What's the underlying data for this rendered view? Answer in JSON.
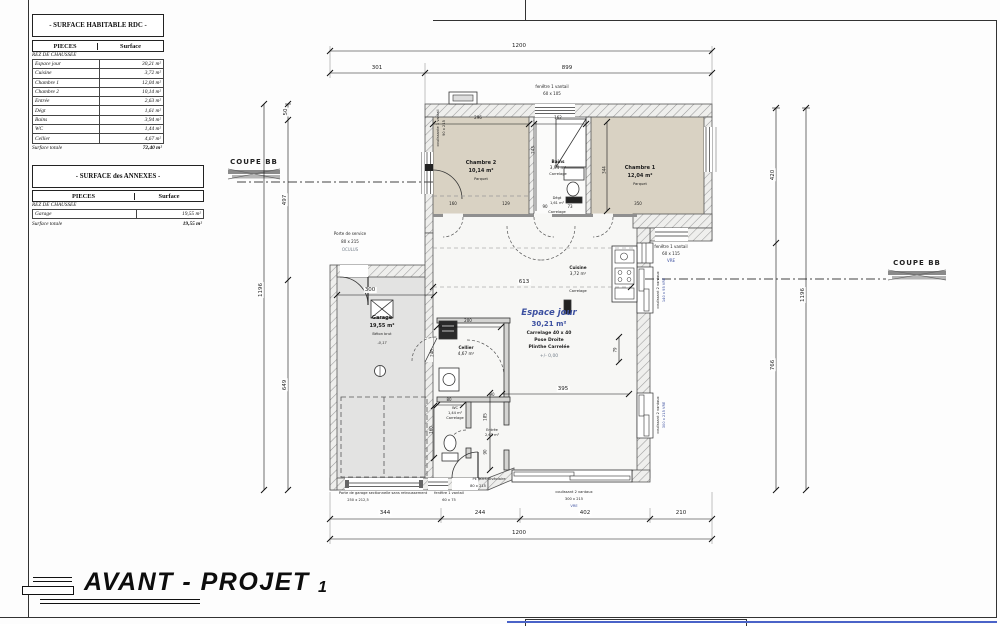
{
  "tables": {
    "habitable": {
      "title": "- SURFACE HABITABLE RDC -",
      "col1": "PIECES",
      "col2": "Surface",
      "section": "REZ DE CHAUSSEE",
      "rows": [
        [
          "Espace jour",
          "30,21 m²"
        ],
        [
          "Cuisine",
          "3,72 m²"
        ],
        [
          "Chambre 1",
          "12,04 m²"
        ],
        [
          "Chambre 2",
          "10,14 m²"
        ],
        [
          "Entrée",
          "2,63 m²"
        ],
        [
          "Dégt",
          "1,61 m²"
        ],
        [
          "Bains",
          "3,94 m²"
        ],
        [
          "WC",
          "1,44 m²"
        ],
        [
          "Cellier",
          "4,67 m²"
        ]
      ],
      "total_label": "Surface totale",
      "total": "72,40 m²"
    },
    "annexes": {
      "title": "- SURFACE des ANNEXES -",
      "col1": "PIECES",
      "col2": "Surface",
      "section": "REZ DE CHAUSSEE",
      "rows": [
        [
          "Garage",
          "19,55 m²"
        ]
      ],
      "total_label": "Surface totale",
      "total": "19,55 m²"
    }
  },
  "coupe": {
    "label": "COUPE BB"
  },
  "title_block": {
    "title": "AVANT - PROJET",
    "number": "1"
  },
  "rooms": {
    "chambre2": {
      "name": "Chambre 2",
      "area": "10,14 m²",
      "finish": "Parquet"
    },
    "bains": {
      "name": "Bains",
      "area": "3,94 m²",
      "finish": "Carrelage"
    },
    "chambre1": {
      "name": "Chambre 1",
      "area": "12,04 m²",
      "finish": "Parquet"
    },
    "degt": {
      "name": "Dégt",
      "area": "1,61 m²",
      "finish": "Carrelage"
    },
    "cuisine": {
      "name": "Cuisine",
      "area": "3,72 m²",
      "finish": "Carrelage"
    },
    "espace_jour": {
      "name": "Espace jour",
      "area": "30,21 m²",
      "line1": "Carrelage 40 x 40",
      "line2": "Pose Droite",
      "line3": "Plinthe Carrelée",
      "line4": "+/- 0,00"
    },
    "garage": {
      "name": "Garage",
      "area": "19,55 m²",
      "finish": "Béton brut",
      "level": "-0,17"
    },
    "cellier": {
      "name": "Cellier",
      "area": "4,67 m²"
    },
    "wc": {
      "name": "WC",
      "area": "1,44 m²",
      "finish": "Carrelage"
    },
    "entree": {
      "name": "Entrée",
      "area": "2,63 m²"
    }
  },
  "openings": {
    "fenetre_top": {
      "l1": "fenêtre 1 vantail",
      "l2": "60 x 105"
    },
    "porte_service": {
      "l1": "Porte de service",
      "l2": "80 x 215",
      "l3": "OCULUS"
    },
    "fenetre_gauche": {
      "l1": "coulissante 1 vantail",
      "l2": "90 x 215"
    },
    "fenetre_115": {
      "l1": "fenêtre 1 vantail",
      "l2": "60 x 115",
      "l3": "VRE"
    },
    "coulissant_140": {
      "l1": "coulissant 2 vantaux",
      "l2": "140 x 95 VRE"
    },
    "coulissant_300_droite": {
      "l1": "coulissant 2 vantaux",
      "l2": "300 x 215 VRE"
    },
    "porte_garage": {
      "l1": "Porte de garage sectionnelle sans retroussement",
      "l2": "250 x 212,5"
    },
    "fenetre_75": {
      "l1": "fenêtre 1 vantail",
      "l2": "60 x 75"
    },
    "porte_entree": {
      "l1": "PE BOIS Alvéolaire",
      "l2": "80 x 215"
    },
    "coulissant_300_bas": {
      "l1": "coulissant 2 vantaux",
      "l2": "300 x 215",
      "l3": "VRE"
    }
  },
  "dims": {
    "t1200": "1200",
    "t301": "301",
    "t899": "899",
    "b344": "344",
    "b244": "244",
    "b402": "402",
    "b210": "210",
    "b1200": "1200",
    "l50": "50",
    "l497": "497",
    "l649": "649",
    "l1196": "1196",
    "r420": "420",
    "r766": "766",
    "r1196": "1196",
    "w296": "296",
    "w162": "162",
    "v243": "243",
    "v344": "344",
    "c160": "160",
    "c129": "129",
    "c90": "90",
    "c73": "73",
    "w350": "350",
    "e613": "613",
    "g300": "300",
    "c200": "200",
    "v246": "246",
    "v79": "79",
    "e395": "395",
    "w80": "80",
    "h90": "90",
    "v185": "185",
    "v90": "90"
  },
  "colors": {
    "accent_blue": "#3c50a0",
    "room_beige": "#d9d2c3",
    "garage_gray": "#e3e3e2",
    "bottom_bar_blue": "#4a63c8"
  }
}
